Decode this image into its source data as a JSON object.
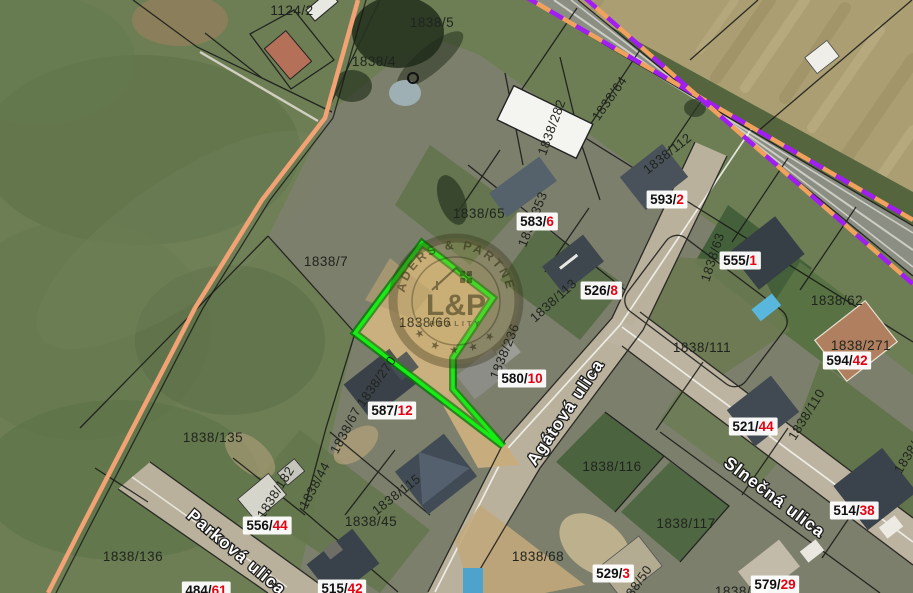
{
  "map": {
    "title": "cadastral-satellite-map",
    "highlight_color": "#14ee14",
    "highlight_edge_color": "#067806",
    "boundary_line_color": "#f2a274",
    "dash_color_purple": "#a21df2",
    "dash_color_orange": "#f2a05e",
    "house_number_color": "#e60012",
    "highlight_parcel_points": "422,243 493,298 453,358 453,389 503,446 355,333"
  },
  "watermark": {
    "brand_arc": "LEADERS & PARTNERS",
    "logo": "L&P",
    "logo_sub": "REALITY",
    "stars": "★ ★ ★ ★ ★"
  },
  "streets": [
    {
      "t": "Agátová ulica",
      "x": 565,
      "y": 412,
      "r": -56
    },
    {
      "t": "Slnečná ulica",
      "x": 775,
      "y": 497,
      "r": 37
    },
    {
      "t": "Parková ulica",
      "x": 237,
      "y": 552,
      "r": 40
    }
  ],
  "labels": {
    "plain": [
      {
        "t": "1124/2",
        "x": 292,
        "y": 10
      },
      {
        "t": "1838/5",
        "x": 432,
        "y": 22
      },
      {
        "t": "1838/4",
        "x": 374,
        "y": 61
      },
      {
        "t": "1838/7",
        "x": 326,
        "y": 261
      },
      {
        "t": "1838/65",
        "x": 479,
        "y": 213
      },
      {
        "t": "1838/66",
        "x": 425,
        "y": 322
      },
      {
        "t": "1838/62",
        "x": 837,
        "y": 300
      },
      {
        "t": "1838/271",
        "x": 861,
        "y": 345
      },
      {
        "t": "1838/111",
        "x": 702,
        "y": 347
      },
      {
        "t": "1838/116",
        "x": 612,
        "y": 466
      },
      {
        "t": "1838/117",
        "x": 686,
        "y": 523
      },
      {
        "t": "1838/68",
        "x": 538,
        "y": 556
      },
      {
        "t": "1838/135",
        "x": 213,
        "y": 437
      },
      {
        "t": "1838/136",
        "x": 133,
        "y": 556
      },
      {
        "t": "1838/45",
        "x": 371,
        "y": 521
      },
      {
        "t": "1838/",
        "x": 733,
        "y": 591
      }
    ],
    "rotated": [
      {
        "t": "1838/282",
        "x": 551,
        "y": 127,
        "r": -70
      },
      {
        "t": "1838/64",
        "x": 609,
        "y": 98,
        "r": -55
      },
      {
        "t": "1838/112",
        "x": 667,
        "y": 153,
        "r": -38
      },
      {
        "t": "1838/353",
        "x": 532,
        "y": 219,
        "r": -68
      },
      {
        "t": "1838/113",
        "x": 553,
        "y": 300,
        "r": -42
      },
      {
        "t": "1838/236",
        "x": 504,
        "y": 351,
        "r": -68
      },
      {
        "t": "1838/63",
        "x": 712,
        "y": 257,
        "r": -72
      },
      {
        "t": "1838/110",
        "x": 806,
        "y": 414,
        "r": -58
      },
      {
        "t": "1838/270",
        "x": 376,
        "y": 381,
        "r": -55
      },
      {
        "t": "1838/67",
        "x": 345,
        "y": 430,
        "r": -62
      },
      {
        "t": "1838/44",
        "x": 314,
        "y": 485,
        "r": -62
      },
      {
        "t": "1838/182",
        "x": 275,
        "y": 492,
        "r": -58
      },
      {
        "t": "1838/115",
        "x": 396,
        "y": 494,
        "r": -38
      },
      {
        "t": "1838/50",
        "x": 634,
        "y": 587,
        "r": -55
      },
      {
        "t": "1838/",
        "x": 906,
        "y": 457,
        "r": -58
      }
    ],
    "boxed": [
      {
        "m": "593/",
        "s": "2",
        "x": 667,
        "y": 199
      },
      {
        "m": "583/",
        "s": "6",
        "x": 537,
        "y": 221
      },
      {
        "m": "526/",
        "s": "8",
        "x": 601,
        "y": 290
      },
      {
        "m": "555/",
        "s": "1",
        "x": 740,
        "y": 260
      },
      {
        "m": "594/",
        "s": "42",
        "x": 847,
        "y": 360
      },
      {
        "m": "580/",
        "s": "10",
        "x": 522,
        "y": 378
      },
      {
        "m": "587/",
        "s": "12",
        "x": 392,
        "y": 410
      },
      {
        "m": "521/",
        "s": "44",
        "x": 753,
        "y": 426
      },
      {
        "m": "556/",
        "s": "44",
        "x": 267,
        "y": 525
      },
      {
        "m": "514/",
        "s": "38",
        "x": 854,
        "y": 510
      },
      {
        "m": "529/",
        "s": "3",
        "x": 613,
        "y": 573
      },
      {
        "m": "579/",
        "s": "29",
        "x": 775,
        "y": 584
      },
      {
        "m": "515/",
        "s": "42",
        "x": 342,
        "y": 588
      },
      {
        "m": "484/",
        "s": "61",
        "x": 206,
        "y": 590
      }
    ]
  }
}
